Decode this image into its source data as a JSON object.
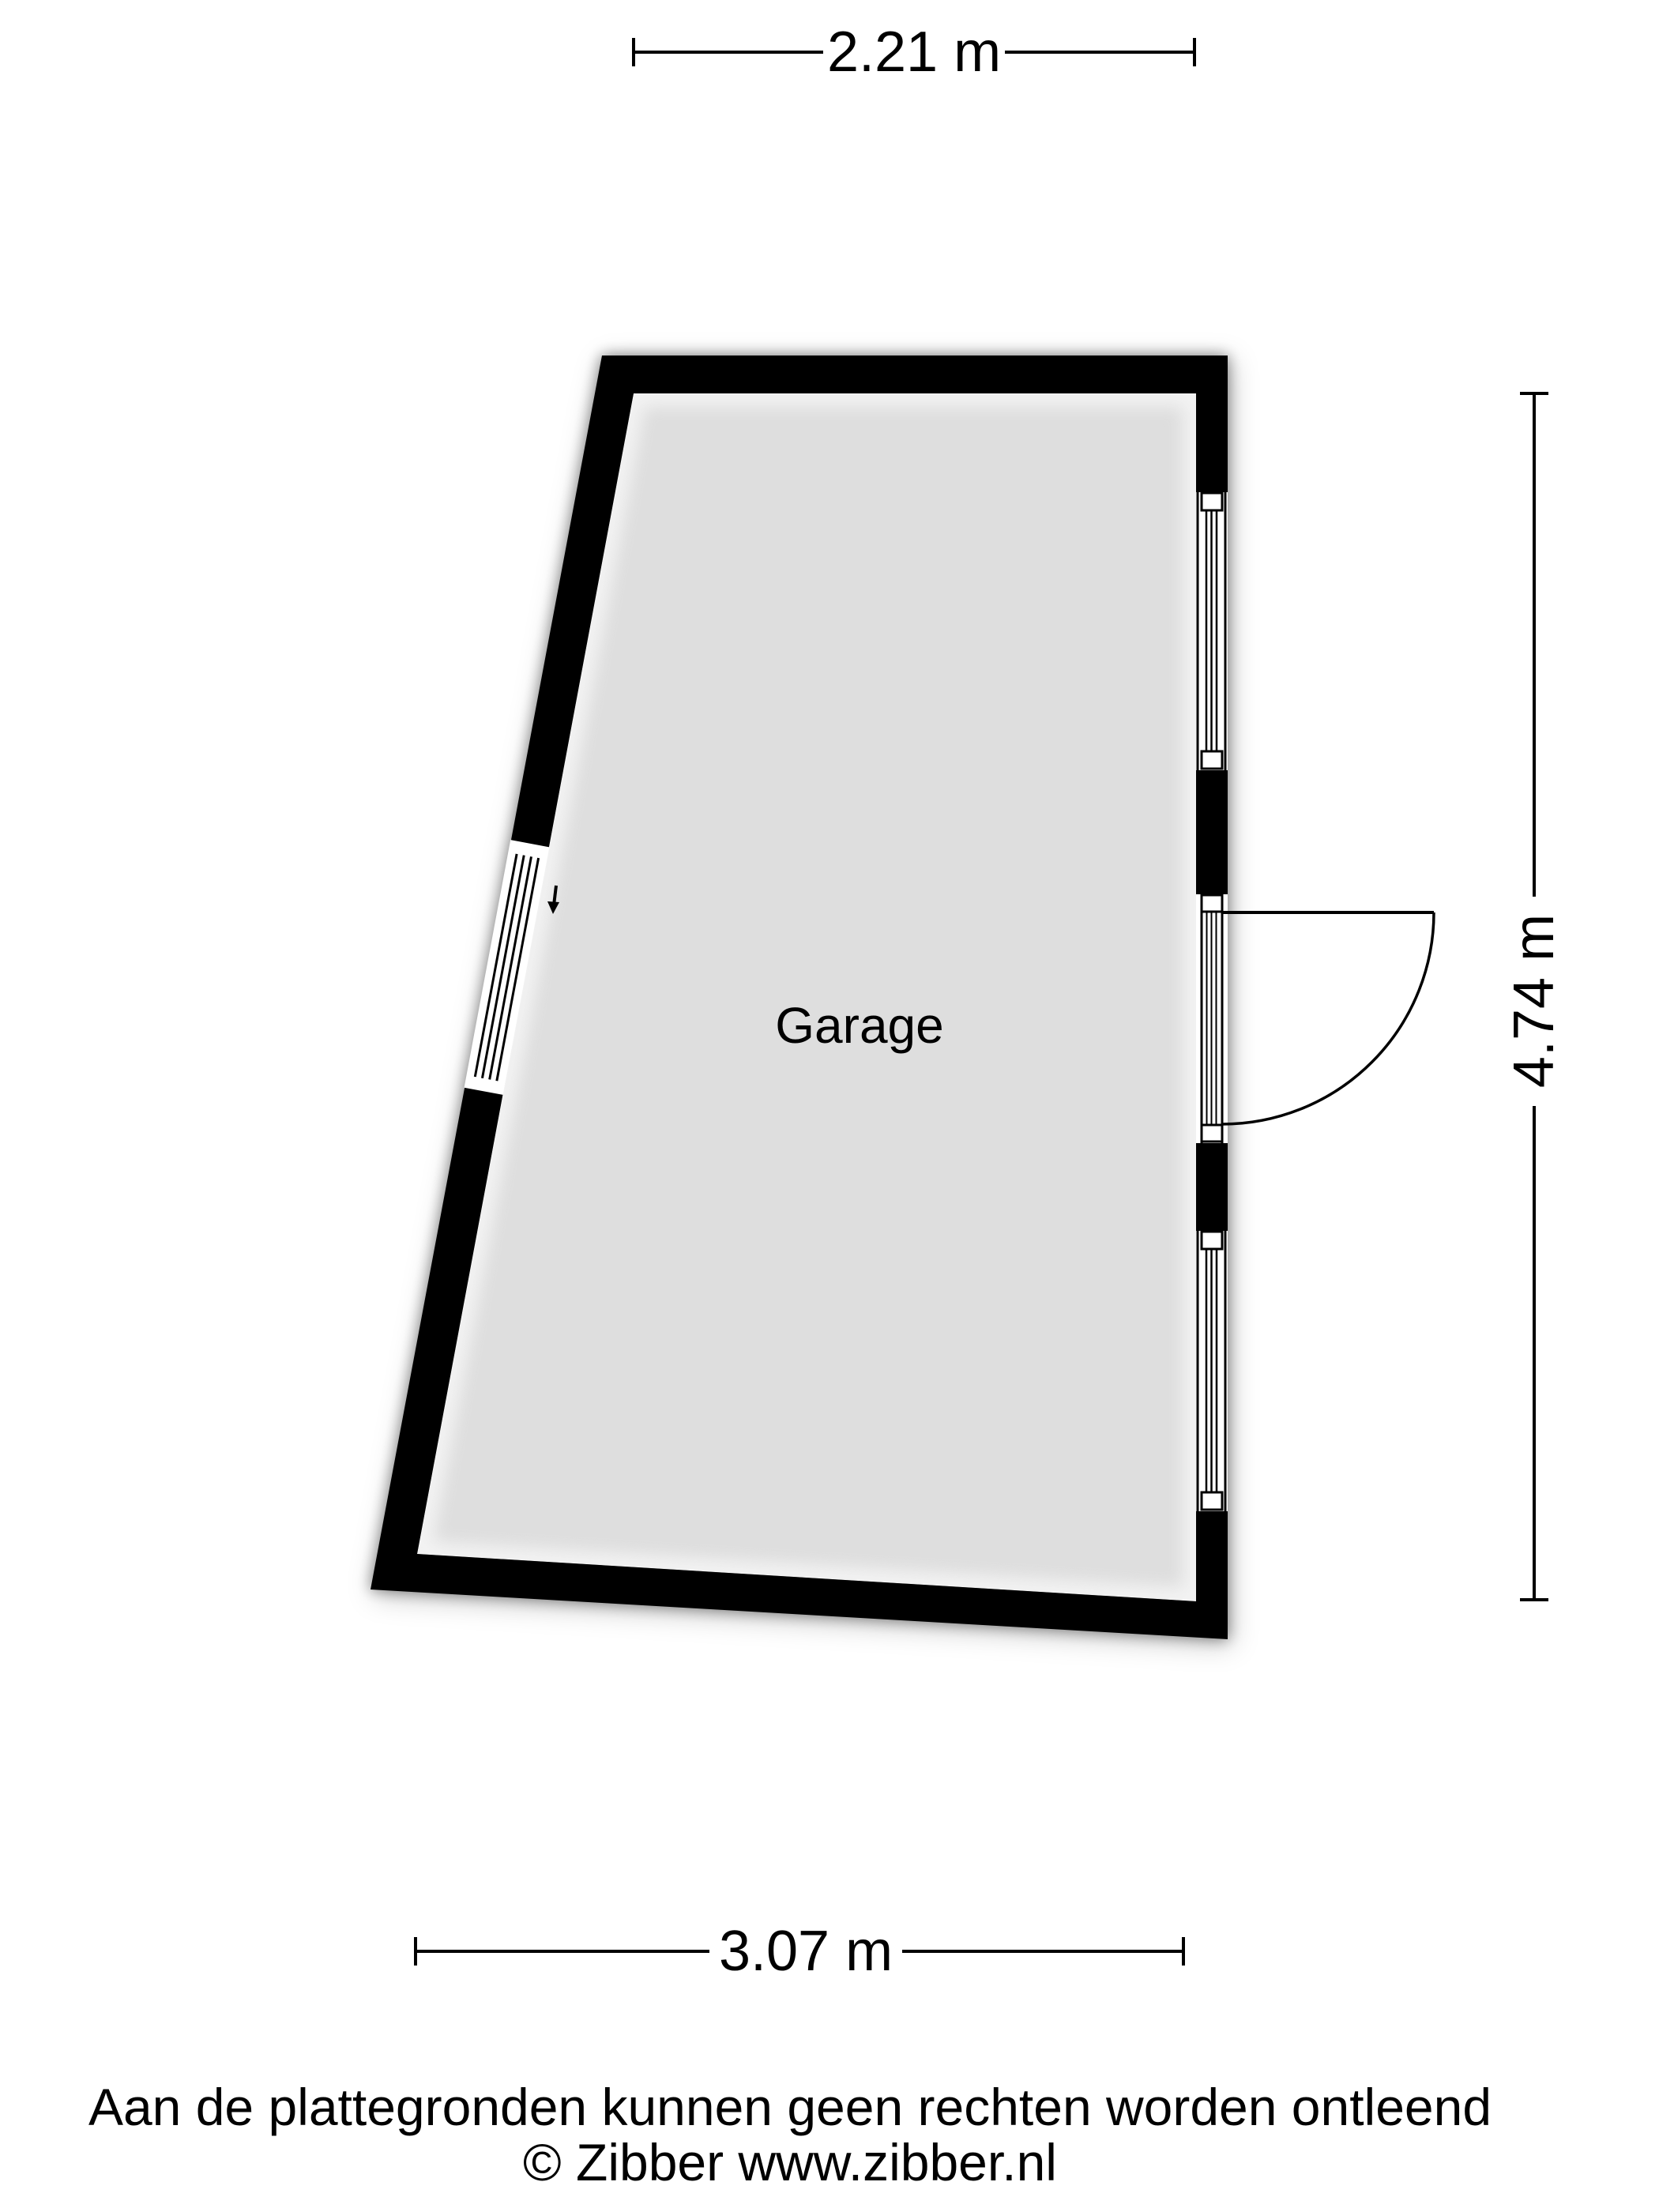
{
  "floorplan": {
    "room_label": "Garage",
    "dim_top": "2.21 m",
    "dim_right": "4.74 m",
    "dim_bottom": "3.07 m",
    "colors": {
      "wall": "#000000",
      "floor": "#dedede",
      "opening": "#ffffff",
      "background": "#ffffff"
    }
  },
  "footer": {
    "disclaimer": "Aan de plattegronden kunnen geen rechten worden ontleend",
    "copyright": "© Zibber www.zibber.nl"
  }
}
